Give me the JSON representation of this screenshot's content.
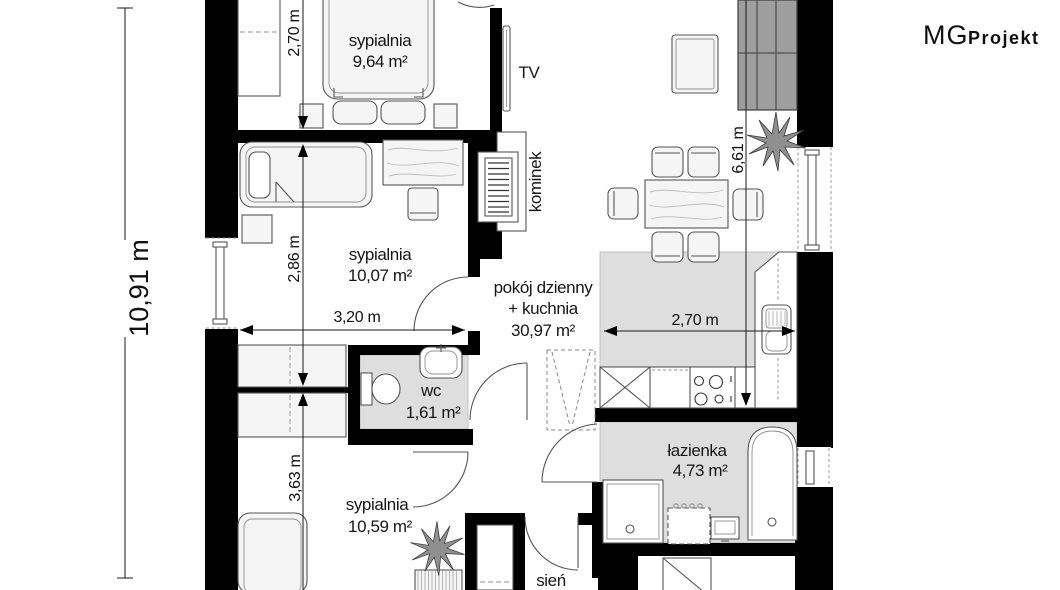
{
  "brand": {
    "name_thin": "MG",
    "name_bold": "Projekt"
  },
  "rooms": {
    "bedroom1": {
      "label": "sypialnia",
      "area": "9,64 m²"
    },
    "bedroom2": {
      "label": "sypialnia",
      "area": "10,07 m²"
    },
    "bedroom3": {
      "label": "sypialnia",
      "area": "10,59 m²"
    },
    "living_kitchen": {
      "label_line1": "pokój dzienny",
      "label_line2": "+ kuchnia",
      "area": "30,97 m²"
    },
    "wc": {
      "label": "wc",
      "area": "1,61 m²"
    },
    "bathroom": {
      "label": "łazienka",
      "area": "4,73 m²"
    },
    "hall": {
      "label": "sień"
    }
  },
  "annotations": {
    "tv": "TV",
    "fireplace": "kominek"
  },
  "dimensions": {
    "overall_height": "10,91 m",
    "bedroom1_height": "2,70 m",
    "bedroom2_height": "2,86 m",
    "bedroom2_width": "3,20 m",
    "bedroom3_height": "3,63 m",
    "kitchen_width": "2,70 m",
    "living_height": "6,61 m"
  },
  "colors": {
    "wall": "#000000",
    "floor_gray": "#dedede",
    "sofa_gray": "#9e9e9e",
    "line": "#555555"
  }
}
